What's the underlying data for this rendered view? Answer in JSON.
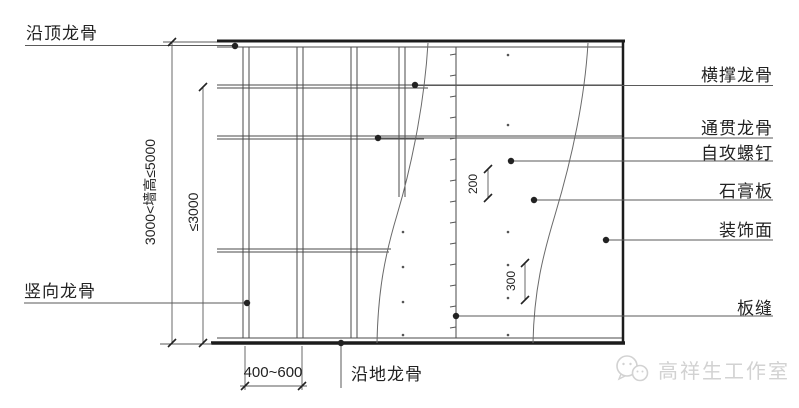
{
  "title": "轻钢龙骨石膏板隔墙构造详图",
  "labels": {
    "top_track": "沿顶龙骨",
    "vertical_stud": "竖向龙骨",
    "cross_brace": "横撑龙骨",
    "through_runner": "通贯龙骨",
    "self_tapping_screw": "自攻螺钉",
    "gypsum_board": "石膏板",
    "decorative_face": "装饰面",
    "board_seam": "板缝",
    "floor_track": "沿地龙骨"
  },
  "dimensions": {
    "wall_height": "3000<墙高≤5000",
    "runner_height": "≤3000",
    "stud_spacing": "400~600",
    "screw_spacing_edge": "200",
    "screw_spacing_field": "300"
  },
  "watermark": {
    "text": "高祥生工作室",
    "icon": "wechat-bubbles-icon"
  },
  "colors": {
    "line_thin": "#4a4a4a",
    "line_thick": "#1c1c1c",
    "leader": "#5a5a5a",
    "watermark": "#d2d2d2"
  }
}
